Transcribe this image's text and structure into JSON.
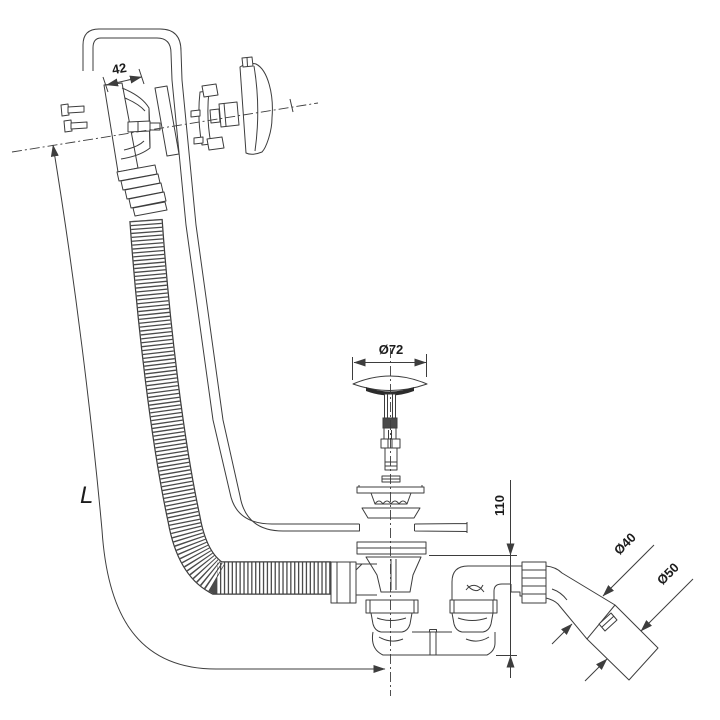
{
  "figure": {
    "description": "Technical exploded-view line drawing of a bathtub waste and overflow drain set: overflow fitting with knob and corrugated hose, pop-up plug, waste body with trap and angled outlet"
  },
  "colors": {
    "line": "#3d3d3d",
    "text": "#1c1c1c",
    "gasket": "#2c2c2c",
    "background": "#ffffff"
  },
  "dimensions": {
    "overflow_depth": "42",
    "plug_cap_diameter": "Ø72",
    "waste_height": "110",
    "outlet_diameter": "Ø40",
    "reducer_outer_diameter": "Ø50",
    "hose_length": "L"
  }
}
